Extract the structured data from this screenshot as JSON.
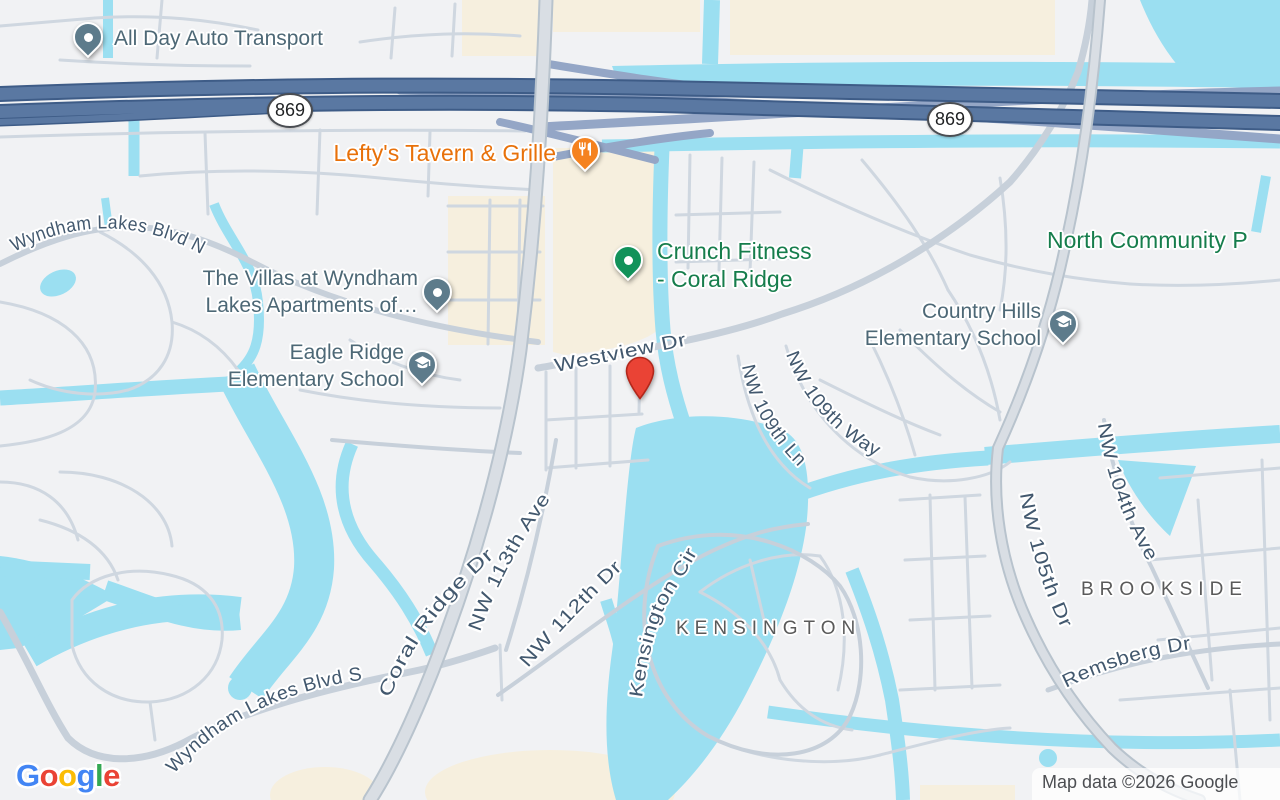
{
  "map": {
    "attribution": "Map data ©2026 Google",
    "logo": {
      "letters": [
        {
          "ch": "G",
          "color": "#4285F4"
        },
        {
          "ch": "o",
          "color": "#EA4335"
        },
        {
          "ch": "o",
          "color": "#FBBC05"
        },
        {
          "ch": "g",
          "color": "#4285F4"
        },
        {
          "ch": "l",
          "color": "#34A853"
        },
        {
          "ch": "e",
          "color": "#EA4335"
        }
      ]
    },
    "route_badges": [
      {
        "label": "869"
      },
      {
        "label": "869"
      }
    ],
    "destination_marker": {
      "color": "#EA4335"
    },
    "areas": {
      "kensington": "KENSINGTON",
      "brookside": "BROOKSIDE"
    },
    "streets": {
      "wyndham_lakes_blvd_n": "Wyndham Lakes Blvd N",
      "westview_dr": "Westview Dr",
      "nw_109th_ln": "NW 109th Ln",
      "nw_109th_way": "NW 109th Way",
      "nw_104th_ave": "NW 104th Ave",
      "nw_105th_dr": "NW 105th Dr",
      "coral_ridge_dr": "Coral Ridge Dr",
      "nw_113th_ave": "NW 113th Ave",
      "nw_112th_dr": "NW 112th Dr",
      "kensington_cir": "Kensington Cir",
      "remsberg_dr": "Remsberg Dr",
      "wyndham_lakes_blvd_s": "Wyndham Lakes Blvd S"
    },
    "pois": {
      "all_day_auto_transport": {
        "name": "All Day Auto Transport",
        "pin_color": "#5d7b8b",
        "text_color": "#4d6876"
      },
      "leftys_tavern": {
        "name": "Lefty's Tavern & Grille",
        "pin_color": "#f5821f",
        "text_color": "#e8710a",
        "icon": "restaurant-icon"
      },
      "crunch_fitness": {
        "line1": "Crunch Fitness",
        "line2": "- Coral Ridge",
        "pin_color": "#12925a",
        "text_color": "#167d4c"
      },
      "villas_wyndham": {
        "line1": "The Villas at Wyndham",
        "line2": "Lakes Apartments of…",
        "pin_color": "#5d7b8b",
        "text_color": "#4d6876"
      },
      "eagle_ridge": {
        "line1": "Eagle Ridge",
        "line2": "Elementary School",
        "pin_color": "#5d7b8b",
        "text_color": "#4d6876",
        "icon": "school-icon"
      },
      "country_hills": {
        "line1": "Country Hills",
        "line2": "Elementary School",
        "pin_color": "#5d7b8b",
        "text_color": "#4d6876",
        "icon": "school-icon"
      },
      "north_community": {
        "name": "North Community P",
        "text_color": "#167d4c"
      }
    },
    "colors": {
      "water": "#9bdff1",
      "land": "#f1f2f4",
      "highway": "#5a78a2",
      "commercial": "#f6efde"
    }
  }
}
